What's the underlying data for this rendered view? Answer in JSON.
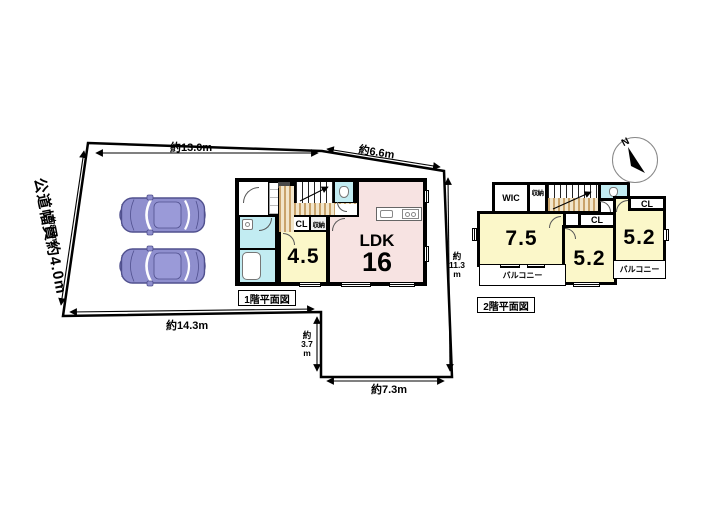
{
  "site": {
    "road_width_label": "公道幅員約4.0m",
    "dim_top": "約13.0m",
    "dim_top_right": "約6.6m",
    "dim_left_edge": "約8.6m",
    "dim_right_edge": "約\n11.3\nm",
    "dim_bottom": "約14.3m",
    "dim_step": "約\n3.7\nm",
    "dim_bottom_right": "約7.3m",
    "parked_cars": 2
  },
  "floor1": {
    "title": "1階平面図",
    "ldk_label": "LDK",
    "ldk_size": "16",
    "tatami_room": "4.5",
    "closet_label": "CL",
    "storage_label": "収納"
  },
  "floor2": {
    "title": "2階平面図",
    "wic_label": "WIC",
    "storage_label": "収納",
    "room_a": "7.5",
    "room_b": "5.2",
    "room_c": "5.2",
    "closet_b": "CL",
    "closet_c": "CL",
    "balcony_a": "バルコニー",
    "balcony_b": "バルコニー"
  },
  "compass": {
    "north_label": "N"
  },
  "colors": {
    "room_pink": "#f7e3e2",
    "room_yellow": "#fbf7c9",
    "water_cyan": "#c2ecf2",
    "wood_floor": "#c9a36b",
    "car_body": "#8f8fce"
  }
}
